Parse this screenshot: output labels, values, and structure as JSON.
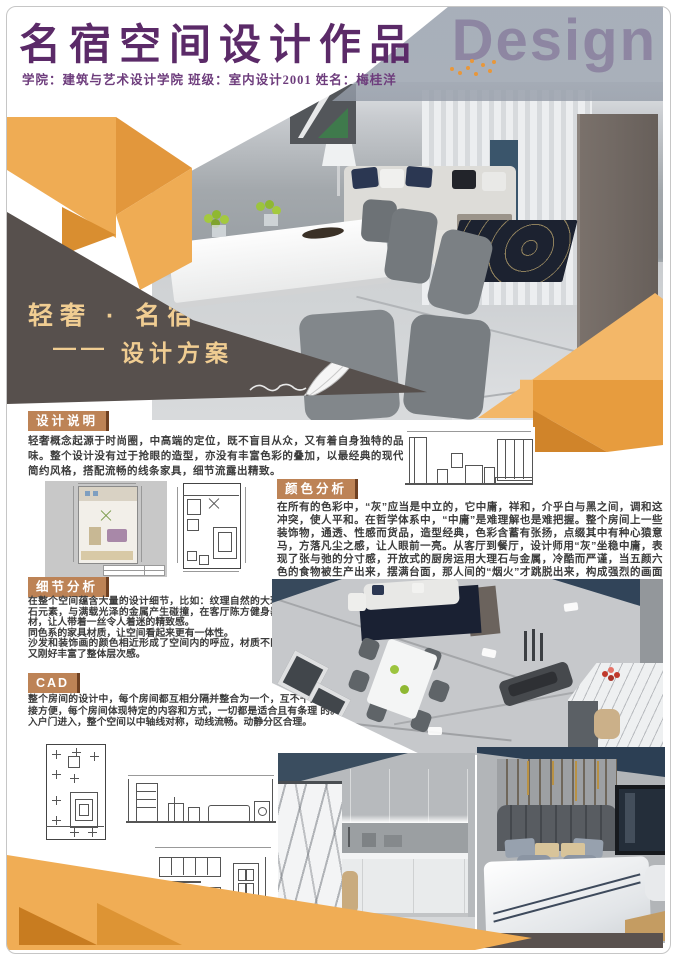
{
  "page": {
    "title": "名宿空间设计作品",
    "subtitle": "学院：建筑与艺术设计学院  班级：室内设计2001  姓名：梅桂洋",
    "watermark": "Design"
  },
  "hero": {
    "tagline_line1": "轻奢 · 名宿",
    "tagline_dash": "——",
    "tagline_line2": "设计方案"
  },
  "sections": {
    "design_note": {
      "heading": "设计说明",
      "body": "轻奢概念起源于时尚圈，中高端的定位，既不盲目从众，又有着自身独特的品味。整个设计没有过于抢眼的造型，亦没有丰富色彩的叠加，以最经典的现代简约风格，搭配流畅的线条家具，细节流露出精致。"
    },
    "color_analysis": {
      "heading": "颜色分析",
      "body": "在所有的色彩中，“灰”应当是中立的，它中庸，祥和，介乎白与黑之间，调和这冲突，使人平和。在哲学体系中，“中庸”是难理解也是难把握。整个房间上一些装饰物，通透、性感而货品，造型经典，色彩含蓄有张扬，点缀其中有种心猿意马，方落凡尘之感，让人眼前一亮。从客厅到餐厅，设计师用“灰”坐稳中庸，表现了张与弛的分寸感，开放式的厨房运用大理石与金属，冷酷而严谨，当五颜六色的食物被生产出来，摆满台面，那人间的“烟火”才跳脱出来，构成强烈的画面感。"
    },
    "detail_analysis": {
      "heading": "细节分析",
      "body_1": "在整个空间蕴含大量的设计细节，比如：纹理自然的大理石元素，与满载光泽的金属产生碰撞，在客厅陈方健身器材，让人带着一丝令人着迷的精致感。",
      "body_2": "同色系的家具材质，让空间看起来更有一体性。",
      "body_3": "沙发和装饰画的颜色相近形成了空间内的呼应，材质不同又刚好丰富了整体层次感。"
    },
    "cad": {
      "heading": "CAD",
      "body": "整个房间的设计中，每个房间都互相分隔并整合为一个，互不干扰，但连接方便，每个房间体现特定的内容和方式，一切都是适合且有条理 的。从入户门进入，整个空间以中轴线对称，动线流畅。动静分区合理。"
    }
  },
  "colors": {
    "title_purple": "#5b2a68",
    "header_tan": "#bd8356",
    "accent_orange_light": "#efac54",
    "accent_orange_mid": "#e2973c",
    "accent_orange_dark": "#d0842a",
    "dark_taupe": "#57504d",
    "gold_text": "#f0cd92"
  }
}
